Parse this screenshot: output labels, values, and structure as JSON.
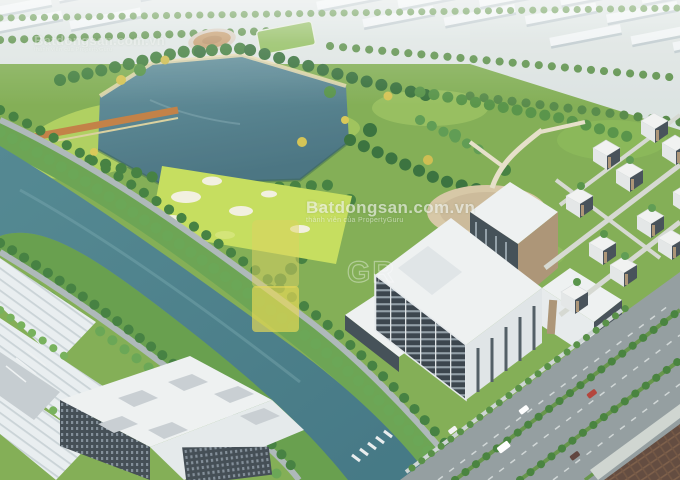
{
  "meta": {
    "kind": "aerial-3d-masterplan-render",
    "width_px": 680,
    "height_px": 480
  },
  "watermark": {
    "brand": "Batdongsan.com.vn",
    "tagline": "thành viên của PropertyGuru",
    "tile_brand": "Batdongsan.com.vn",
    "tile_tagline": "thành viên của PropertyGuru",
    "outline_text": "GR",
    "logo_color": "#e6d74b",
    "text_color": "#ffffff"
  },
  "palette": {
    "lake": "#558591",
    "lake_deep": "#42707d",
    "canal": "#417984",
    "park_green": "#7cab4c",
    "lawn_yellow_green": "#b5d45a",
    "golf_green": "#c3dd55",
    "tree_dark": "#2f6b33",
    "tree_mid": "#4f8f3f",
    "tree_light": "#6fae52",
    "tree_yellow": "#d3c14b",
    "warehouse_roof": "#eff4f5",
    "roof_shadow": "#b9c6ca",
    "road": "#9aa5a6",
    "building_white": "#eef1f2",
    "building_glass": "#36424b",
    "accent_brown": "#ab9173",
    "plaza_tan": "#d6c5a2",
    "path_orange": "#c07a3c",
    "roof_tile_brown": "#5a4134",
    "sand": "#f3f0df",
    "haze": "#ffffff"
  },
  "cars": {
    "colors": [
      "#ffffff",
      "#ffffff",
      "#b03a30",
      "#573a33",
      "#f4f4f4"
    ]
  }
}
